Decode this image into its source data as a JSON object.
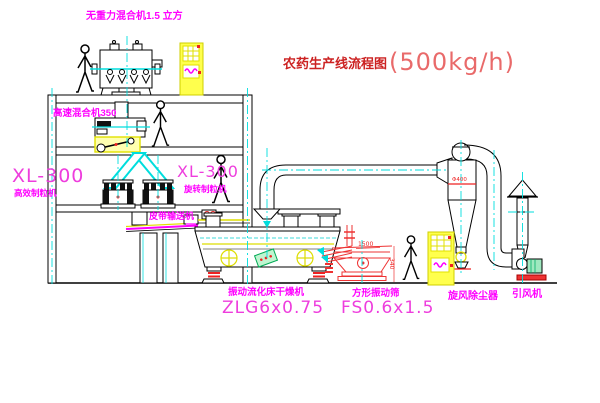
{
  "title": {
    "text": "农药生产线流程图",
    "capacity": "(500kg/h)"
  },
  "labels": {
    "mixer_top": "无重力混合机1.5 立方",
    "mixer_high_speed": "高速混合机350",
    "granulator_left_model": "XL-300",
    "granulator_left_name": "高效制粒机",
    "granulator_mid_model": "XL-300",
    "granulator_mid_name": "旋转制粒机",
    "belt_conveyor": "皮带输送机",
    "dryer_name": "振动流化床干燥机",
    "dryer_model": "ZLG6x0.75",
    "sieve_name": "方形振动筛",
    "sieve_model": "FS0.6x1.5",
    "cyclone": "旋风除尘器",
    "fan": "引风机"
  },
  "dimensions": {
    "sieve_length": "1500",
    "sieve_height": "340",
    "cyclone_dia": "Φ400"
  },
  "colors": {
    "label_magenta": "#ff00ff",
    "model_pink": "#ee3ddd",
    "title_red": "#cc2222",
    "capacity_red": "#e96a6a",
    "centerline_cyan": "#00dddd",
    "highlight_yellow": "#ffff00",
    "machine_red": "#ee3333",
    "background": "#ffffff"
  }
}
